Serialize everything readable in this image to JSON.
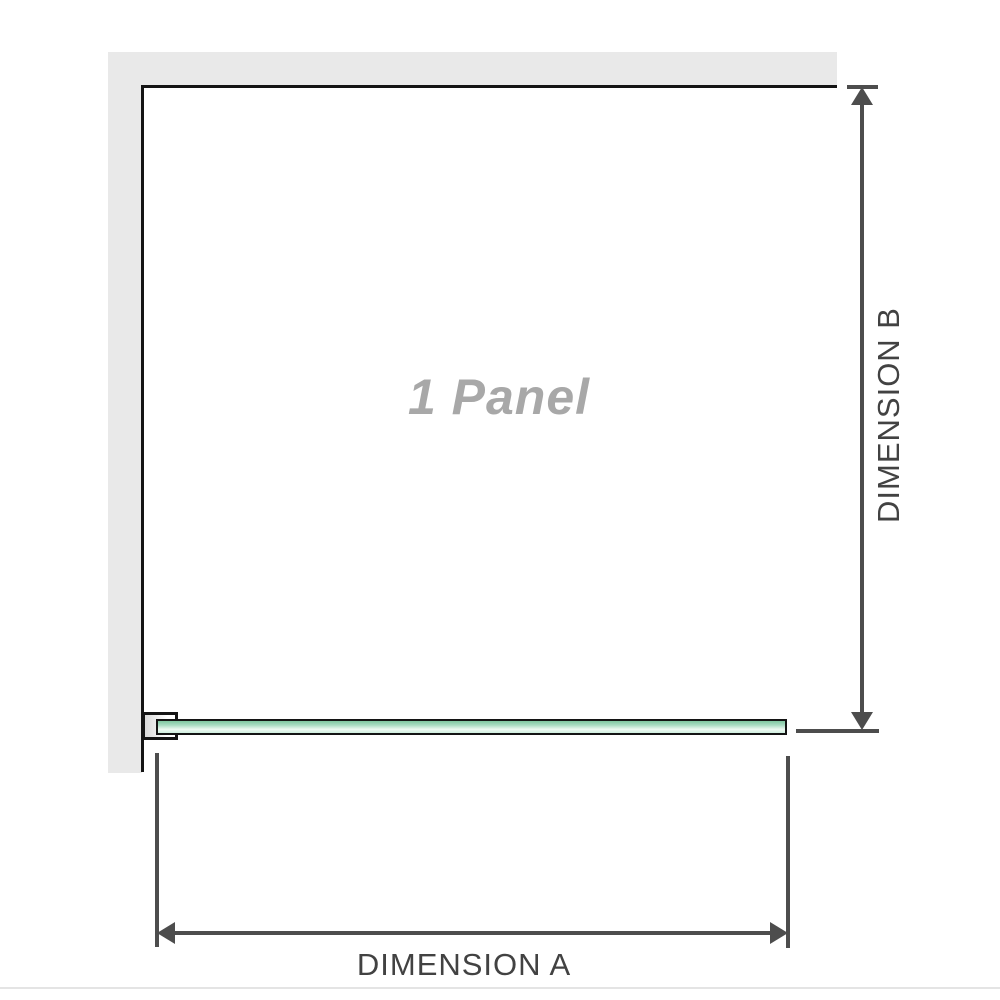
{
  "diagram": {
    "panel_label": "1 Panel",
    "dimension_a": {
      "label": "DIMENSION A"
    },
    "dimension_b": {
      "label": "DIMENSION B"
    },
    "icons": {
      "dimension_a_arrows": "double-headed-horizontal-arrow",
      "dimension_b_arrows": "double-headed-vertical-arrow"
    },
    "colors": {
      "background": "#ffffff",
      "wall_fill": "#e9e9e9",
      "outline": "#141414",
      "glass_green": "#aadcc3",
      "glass_green_dark": "#7fc6a0",
      "glass_green_light": "#eff9f3",
      "bracket_fill": "#d9d9d9",
      "dimension_line": "#4d4d4d",
      "dimension_text": "#424242",
      "panel_text": "#a8a8a8",
      "footer_rule": "#e4e4e4"
    }
  }
}
